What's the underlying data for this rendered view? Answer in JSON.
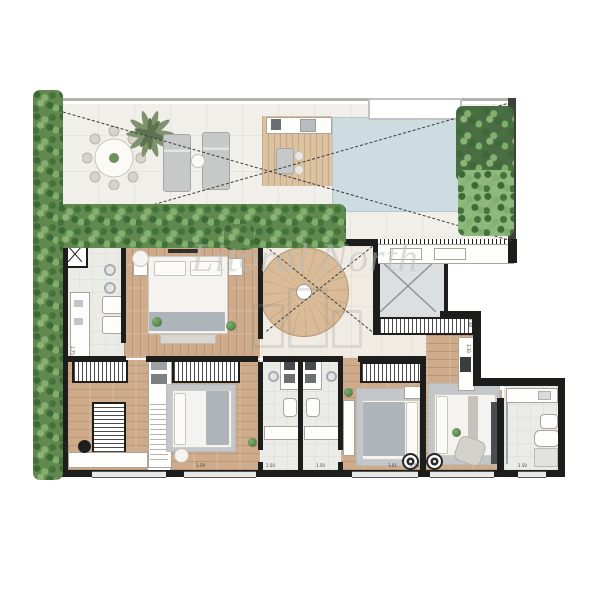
{
  "watermark": {
    "brand": "Litoral North"
  },
  "dims": [
    {
      "v": "1.75"
    },
    {
      "v": "3.59"
    },
    {
      "v": "3.59"
    },
    {
      "v": "1.50"
    },
    {
      "v": "1.50"
    },
    {
      "v": "3.01"
    },
    {
      "v": "5.00"
    },
    {
      "v": "3.30"
    },
    {
      "v": "2.48"
    },
    {
      "v": "1.50"
    }
  ],
  "colors": {
    "wall": "#1d1d1b",
    "wood_floor": "#cdab8b",
    "pool_water": "#ccdce1",
    "hedge_green": "#61894f",
    "hall_floor": "#f0ebe3",
    "rug_gray": "#c3c7ca"
  }
}
